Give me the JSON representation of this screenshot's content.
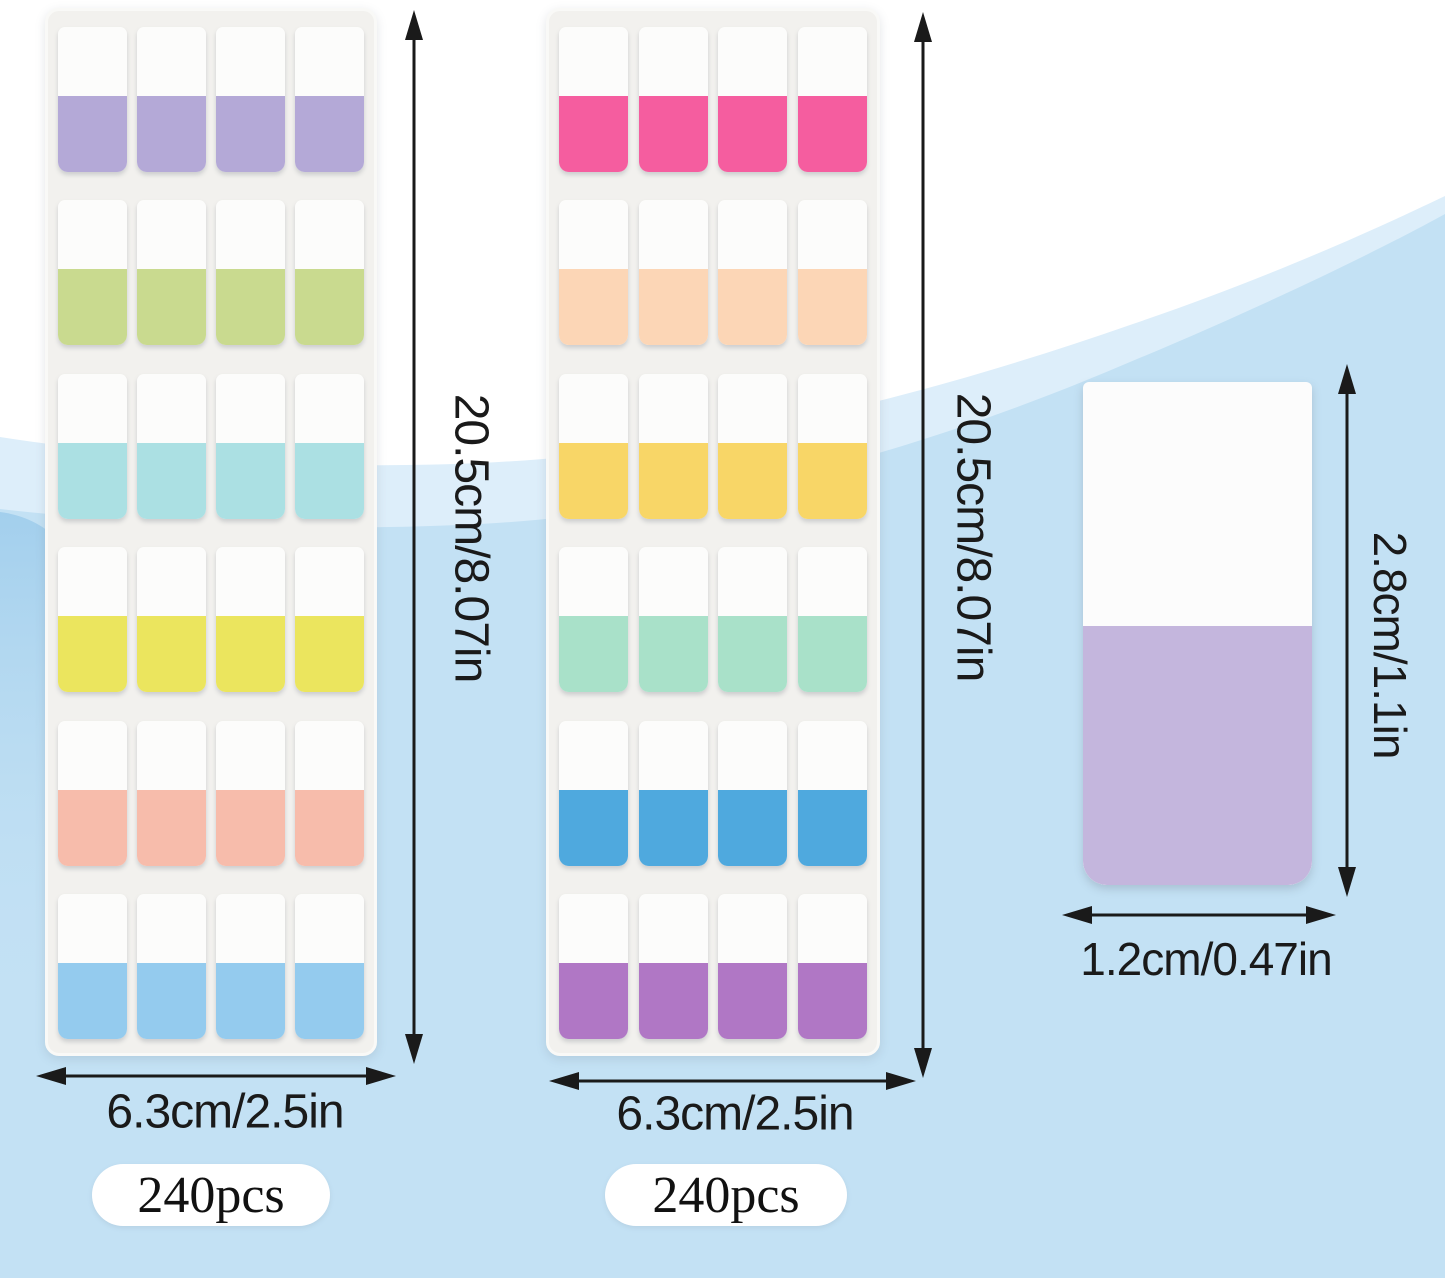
{
  "sheets": [
    {
      "name": "pastel tab sheet",
      "height_label": "20.5cm/8.07in",
      "width_label": "6.3cm/2.5in",
      "count_label": "240pcs",
      "rows": 6,
      "columns": 4,
      "row_colors": [
        "#b4a9d7",
        "#c9da8f",
        "#abe0e3",
        "#ebe55e",
        "#f7bcab",
        "#94cbee"
      ]
    },
    {
      "name": "bright tab sheet",
      "height_label": "20.5cm/8.07in",
      "width_label": "6.3cm/2.5in",
      "count_label": "240pcs",
      "rows": 6,
      "columns": 4,
      "row_colors": [
        "#f55d9f",
        "#fcd6b6",
        "#f8d667",
        "#a9e1c9",
        "#4fa9de",
        "#b077c5"
      ]
    }
  ],
  "single_tab": {
    "height_label": "2.8cm/1.1in",
    "width_label": "1.2cm/0.47in",
    "color": "#c4b6dd"
  },
  "colors": {
    "background_blue": "#c3e1f4",
    "wave_band": "#ddeefa",
    "wave_accent_left": "#9fcdec",
    "sheet_background": "#f2f1ee",
    "tab_top_white": "#fcfcfb",
    "arrow_and_text": "#1a1a1a",
    "badge_background": "#ffffff"
  }
}
